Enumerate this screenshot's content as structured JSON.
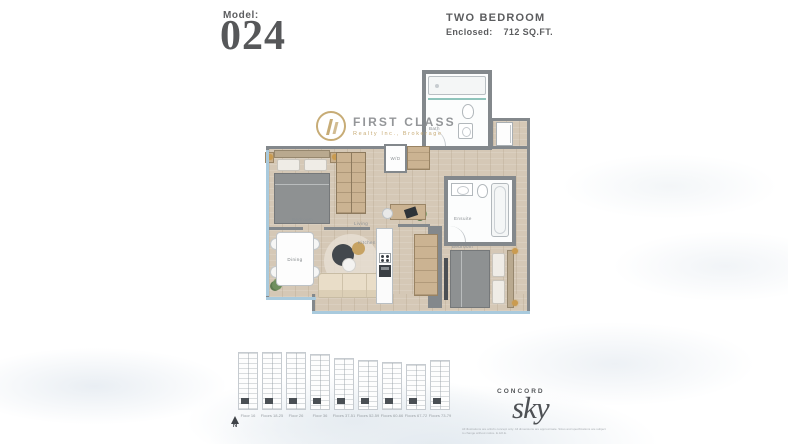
{
  "header": {
    "model_label": "Model:",
    "model_number": "024",
    "unit_type": "TWO BEDROOM",
    "enclosed_label": "Enclosed:",
    "enclosed_value": "712 SQ.FT."
  },
  "watermark": {
    "name": "FIRST CLASS",
    "subtitle": "Realty Inc., Brokerage"
  },
  "plan": {
    "rooms": {
      "bath": "Bath",
      "wd": "W/D",
      "bedroom1": "Bedroom",
      "dining": "Dining",
      "living": "Living",
      "kitchen": "Kitchen",
      "ensuite": "Ensuite",
      "bedroom2": "Bedroom"
    },
    "colors": {
      "wall": "#83888c",
      "floor_wood": "#d5c8b6",
      "window_glass": "#a9cadd",
      "accent_gold": "#c3a56b"
    }
  },
  "keyplans": {
    "north_label": "N",
    "items": [
      {
        "label": "Floor 16"
      },
      {
        "label": "Floors 18-25"
      },
      {
        "label": "Floor 26"
      },
      {
        "label": "Floor 36"
      },
      {
        "label": "Floors 37-51"
      },
      {
        "label": "Floors 52-59"
      },
      {
        "label": "Floors 60-66"
      },
      {
        "label": "Floors 67-72"
      },
      {
        "label": "Floors 73-79"
      }
    ]
  },
  "footer": {
    "brand_top": "CONCORD",
    "brand_main": "sky",
    "disclaimer_line1": "All illustrations are artist's concept only. All dimensions are approximate. Sizes and specifications are subject",
    "disclaimer_line2": "to change without notice. E.&O.E."
  }
}
